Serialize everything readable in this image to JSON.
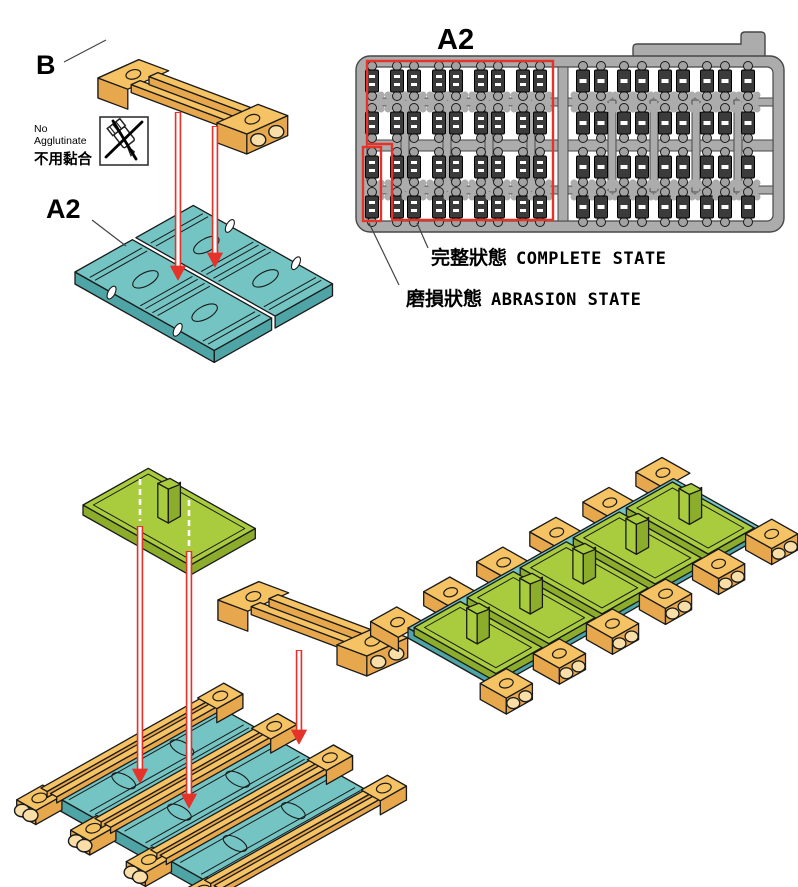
{
  "labels": {
    "part_b": "B",
    "part_a2_left": "A2",
    "sprue_a2": "A2",
    "no_glue_en": "No Agglutinate",
    "no_glue_zh": "不用黏合",
    "complete_state_zh": "完整狀態",
    "complete_state_en": "COMPLETE STATE",
    "abrasion_state_zh": "磨損狀態",
    "abrasion_state_en": "ABRASION  STATE"
  },
  "colors": {
    "orange": "#F5C264",
    "orangeSide": "#E7A84D",
    "orangeBore": "#F9DEA8",
    "teal": "#74C4C4",
    "tealSide": "#4FA4A6",
    "green": "#A9CC3F",
    "greenSide": "#8CAD2C",
    "sprueGray": "#ACACAC",
    "sprueStroke": "#474747",
    "partDark": "#3B3B3B",
    "nub": "#A2A2A2",
    "red": "#E5332A",
    "line": "#1A1A1A"
  },
  "sprue": {
    "rows": 4,
    "left_cols": 9,
    "right_cols": 9,
    "left_mark_count": 2,
    "right_mark_count": 1
  }
}
